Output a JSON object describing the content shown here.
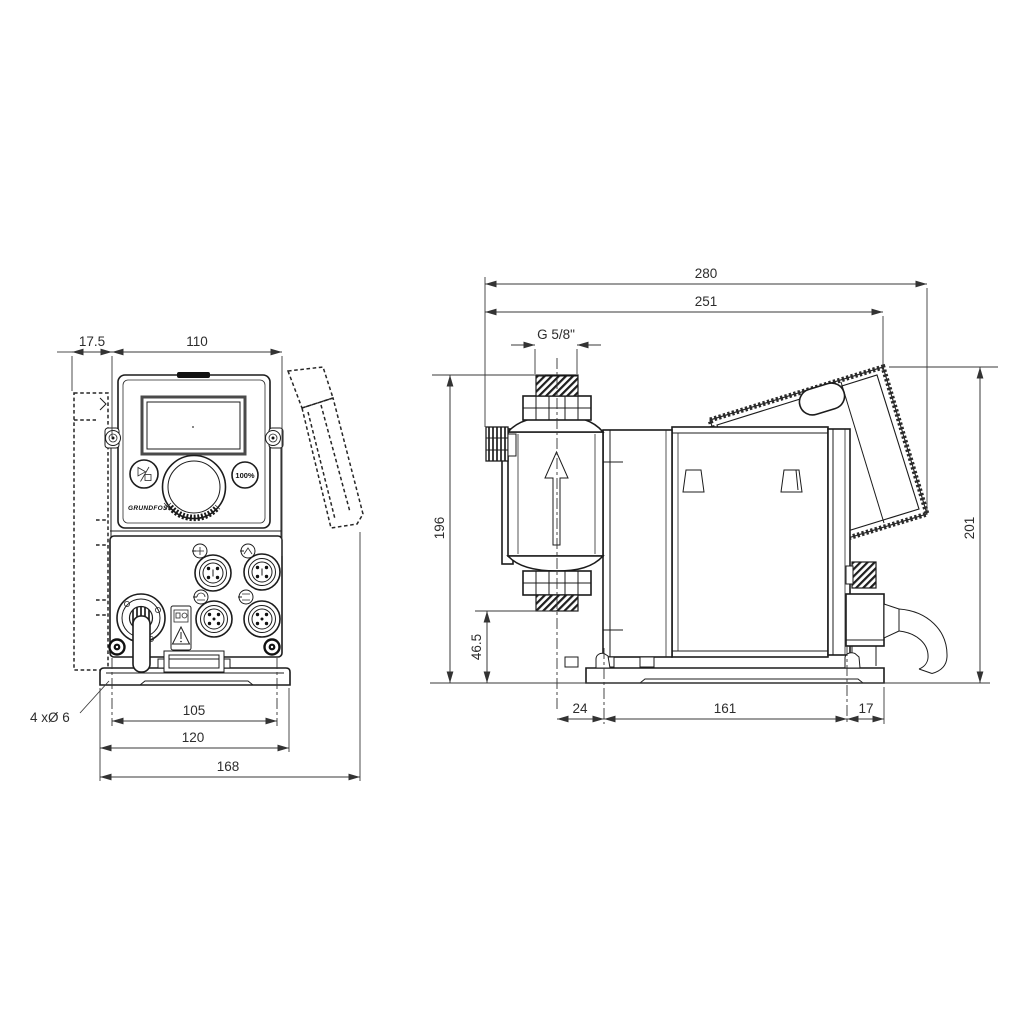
{
  "front": {
    "dims": {
      "back_offset": "17.5",
      "housing_width": "110",
      "mounting_holes": "4 xØ 6",
      "hole_spacing": "105",
      "plate_width": "120",
      "overall_depth": "168"
    },
    "panel": {
      "capacity_button": "100%",
      "brand": "GRUNDFOS"
    }
  },
  "side": {
    "dims": {
      "overall_length": "280",
      "panel_length": "251",
      "thread": "G 5/8\"",
      "inlet_height": "196",
      "valve_bottom_height": "46.5",
      "overall_height": "201",
      "front_to_foot": "24",
      "foot_spacing": "161",
      "foot_to_back": "17"
    }
  },
  "colors": {
    "line": "#1c1c1c",
    "dim": "#3a3a3a",
    "bg": "#ffffff"
  }
}
